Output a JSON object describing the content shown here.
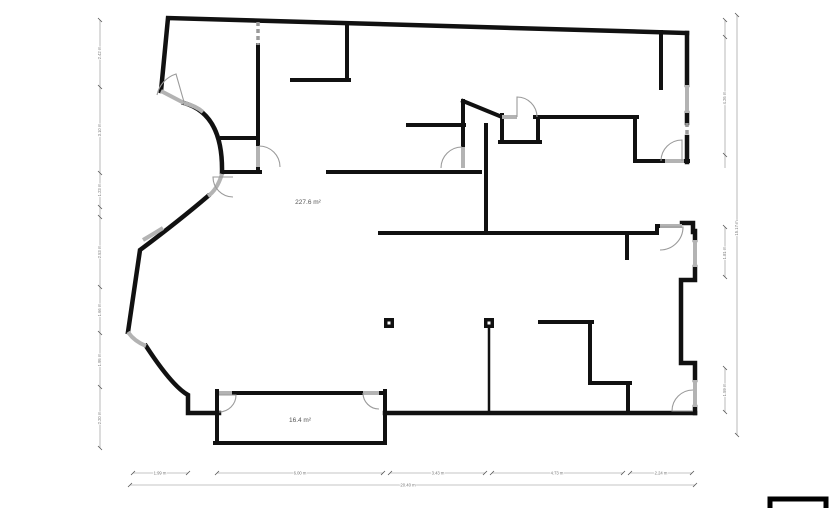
{
  "document": {
    "type": "floor-plan",
    "background": "#ffffff"
  },
  "floorplan": {
    "areas": {
      "main": "227.6 m²",
      "room": "16.4 m²"
    },
    "dims": {
      "b1": "1.99 m",
      "b2": "6.00 m",
      "b3": "3.43 m",
      "b4": "4.73 m",
      "b5": "2.24 m",
      "btotal": "20.40 m",
      "l1": "2.42 m",
      "l2": "3.10 m",
      "l3": "1.23 m",
      "l4": "2.53 m",
      "l5": "1.66 m",
      "l6": "1.95 m",
      "l7": "2.20 m",
      "r1": "4.26 m",
      "r2": "1.81 m",
      "r3": "1.59 m",
      "rtotal": "15.17 m"
    },
    "colors": {
      "wall": "#111111",
      "window_opening": "#b3b3b3",
      "door_arc": "#9a9a9a",
      "dimension": "#8a8a8a"
    }
  }
}
